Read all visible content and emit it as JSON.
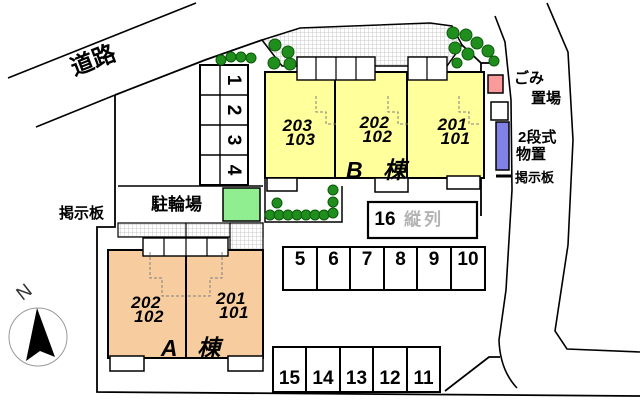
{
  "plan": {
    "road_label": "道路",
    "north_label": "N",
    "bulletin_board_left": "掲示板",
    "bicycle_parking_label": "駐輪場",
    "garbage_area": {
      "line1": "ごみ",
      "line2": "置場"
    },
    "storage": {
      "line1": "2段式",
      "line2": "物置"
    },
    "bulletin_board_right": "掲示板"
  },
  "buildings": {
    "a": {
      "label": "A 棟",
      "fill": "#F7CD9F",
      "units": [
        {
          "upper": "202",
          "lower": "102"
        },
        {
          "upper": "201",
          "lower": "101"
        }
      ]
    },
    "b": {
      "label": "B 棟",
      "fill": "#FFFF9C",
      "units": [
        {
          "upper": "203",
          "lower": "103"
        },
        {
          "upper": "202",
          "lower": "102"
        },
        {
          "upper": "201",
          "lower": "101"
        }
      ]
    }
  },
  "parking": {
    "side_column": [
      "1",
      "2",
      "3",
      "4"
    ],
    "tandem": {
      "number": "16",
      "note": "縦列"
    },
    "middle_row": [
      "5",
      "6",
      "7",
      "8",
      "9",
      "10"
    ],
    "bottom_row": [
      "15",
      "14",
      "13",
      "12",
      "11"
    ]
  },
  "colors": {
    "building_a": "#F7CD9F",
    "building_b": "#FFFF9C",
    "bicycle_area": "#90EE90",
    "tree": "#1F8E1C",
    "garbage_box": "#FA9A9A",
    "storage_box": "#8282E6",
    "tandem_note_gray": "#B3B3B3"
  }
}
